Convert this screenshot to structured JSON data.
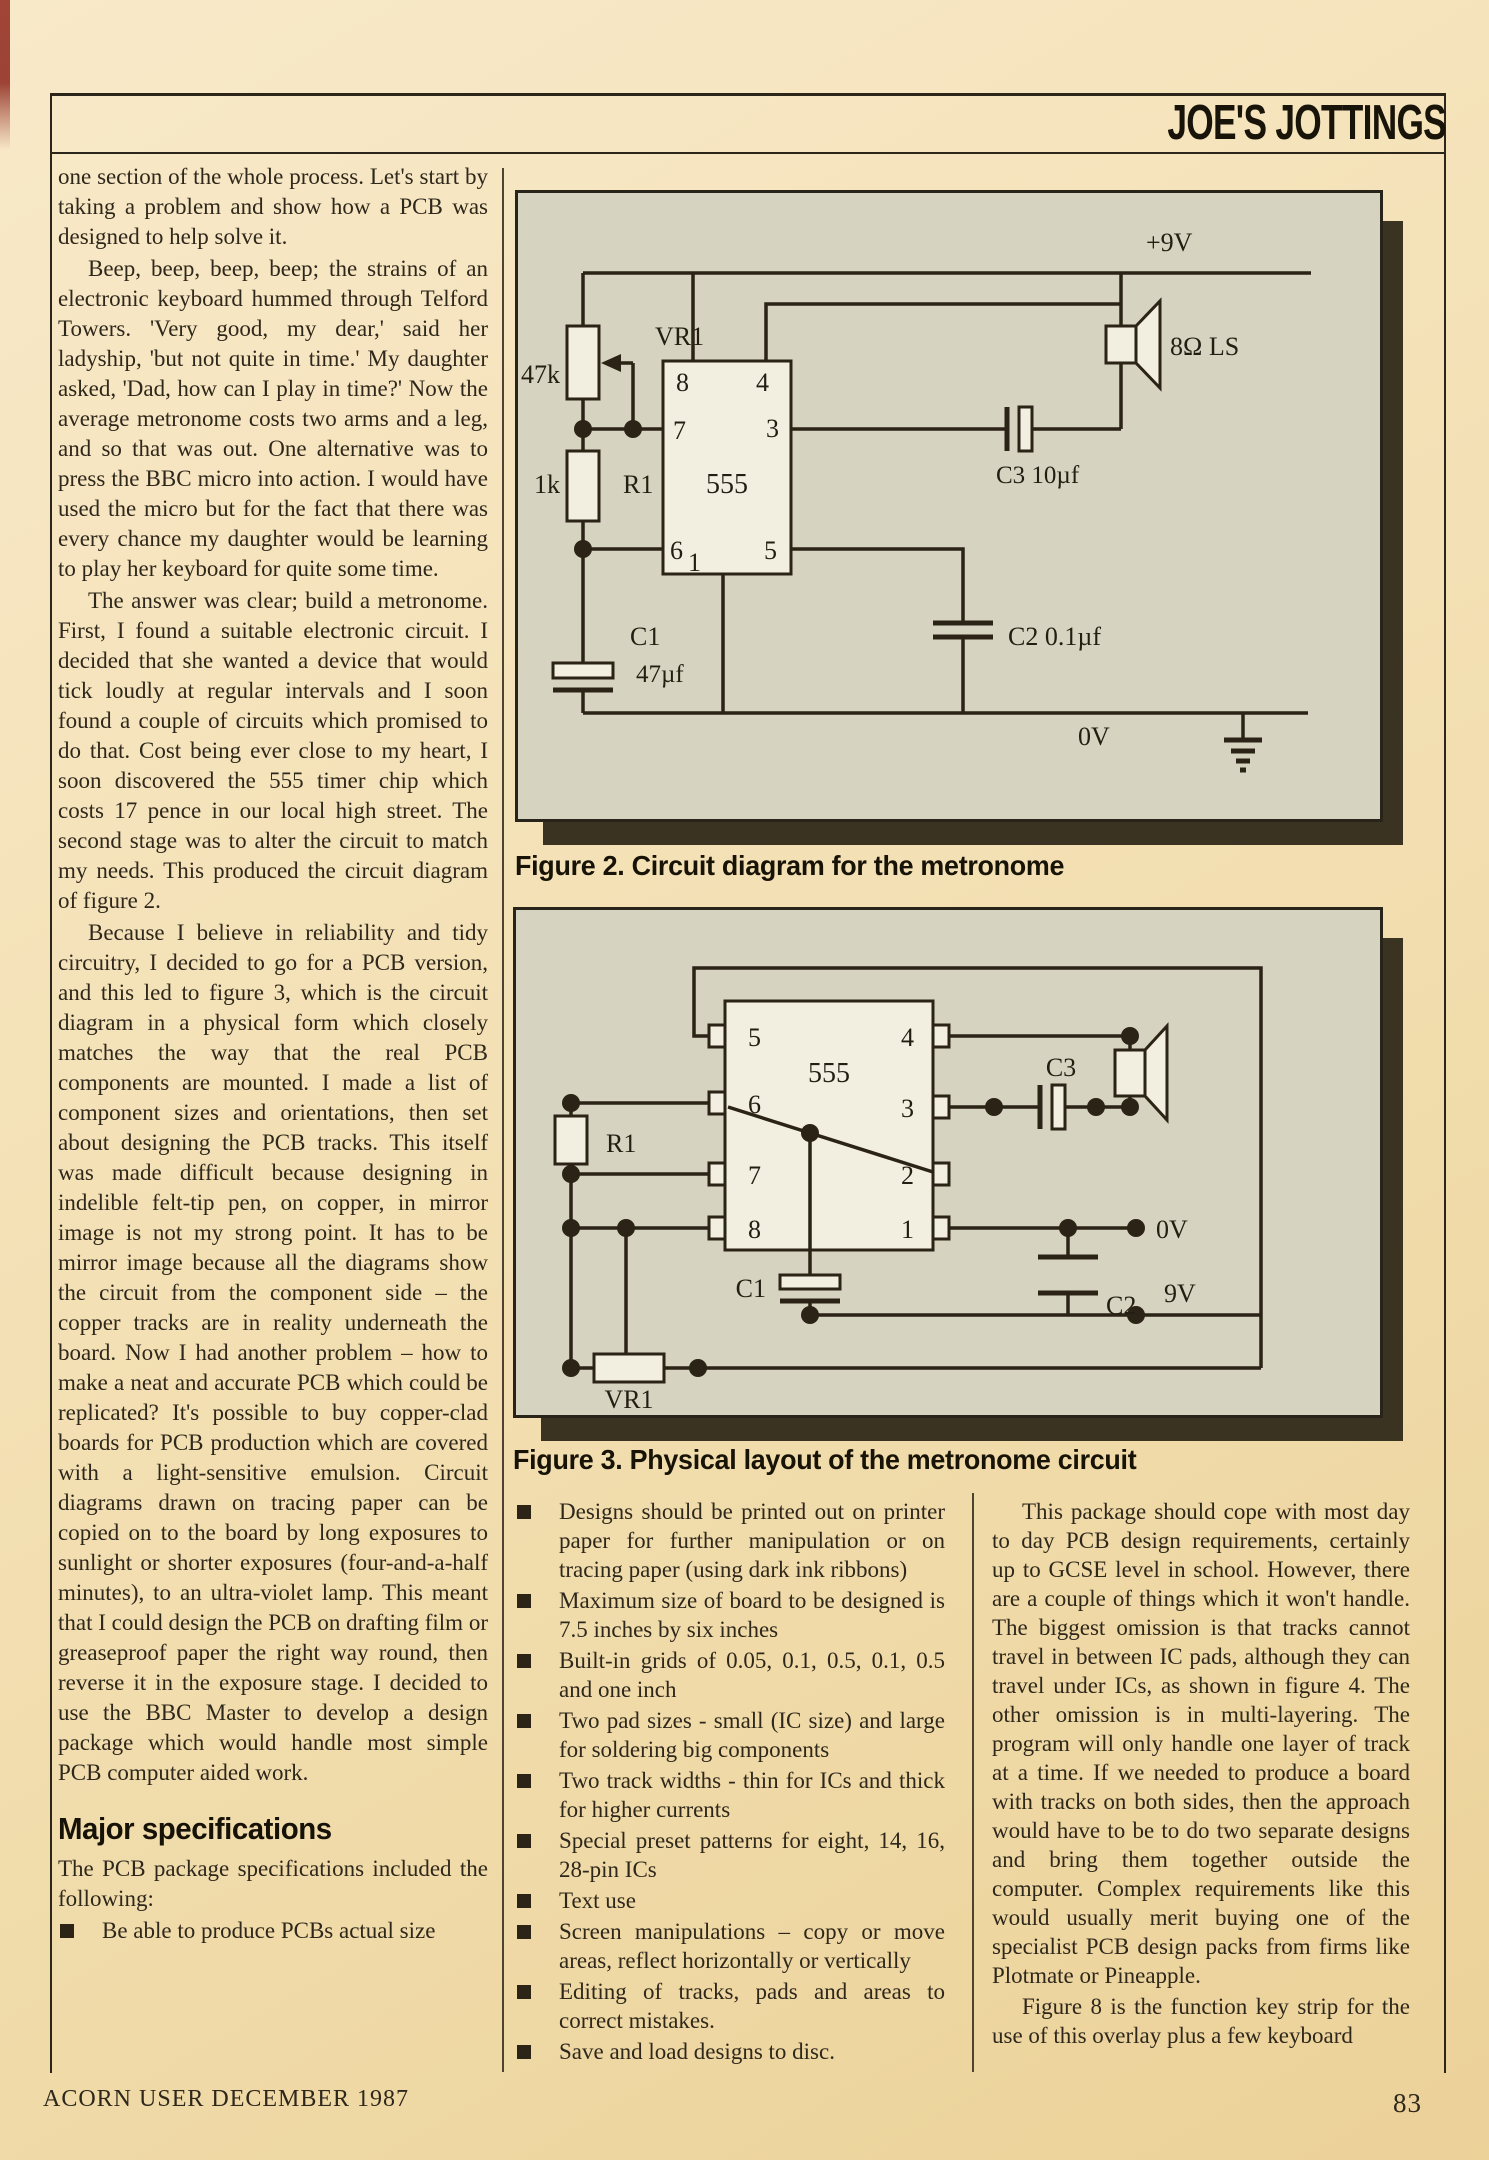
{
  "page": {
    "masthead": "JOE'S JOTTINGS",
    "footer_left": "ACORN USER DECEMBER 1987",
    "footer_right": "83"
  },
  "article": {
    "col1": {
      "p0": "one section of the whole process. Let's start by taking a problem and show how a PCB was designed to help solve it.",
      "p1": "Beep, beep, beep, beep; the strains of an electronic keyboard hummed through Telford Towers. 'Very good, my dear,' said her ladyship, 'but not quite in time.' My daughter asked, 'Dad, how can I play in time?' Now the average metronome costs two arms and a leg, and so that was out. One alternative was to press the BBC micro into action. I would have used the micro but for the fact that there was every chance my daughter would be learning to play her keyboard for quite some time.",
      "p2": "The answer was clear; build a metronome. First, I found a suitable electronic circuit. I decided that she wanted a device that would tick loudly at regular intervals and I soon found a couple of circuits which promised to do that. Cost being ever close to my heart, I soon discovered the 555 timer chip which costs 17 pence in our local high street. The second stage was to alter the circuit to match my needs. This produced the circuit diagram of figure 2.",
      "p3": "Because I believe in reliability and tidy circuitry, I decided to go for a PCB version, and this led to figure 3, which is the circuit diagram in a physical form which closely matches the way that the real PCB components are mounted. I made a list of component sizes and orientations, then set about designing the PCB tracks. This itself was made difficult because designing in indelible felt-tip pen, on copper, in mirror image is not my strong point. It has to be mirror image because all the diagrams show the circuit from the component side – the copper tracks are in reality underneath the board. Now I had another problem – how to make a neat and accurate PCB which could be replicated? It's possible to buy copper-clad boards for PCB production which are covered with a light-sensitive emulsion. Circuit diagrams drawn on tracing paper can be copied on to the board by long exposures to sunlight or shorter exposures (four-and-a-half minutes), to an ultra-violet lamp. This meant that I could design the PCB on drafting film or greaseproof paper the right way round, then reverse it in the exposure stage. I decided to use the BBC Master to develop a design package which would handle most simple PCB computer aided work.",
      "heading": "Major specifications",
      "intro": "The PCB package specifications included the following:",
      "bullet0": "Be able to produce PCBs actual size"
    },
    "middle_bullets": [
      "Designs should be printed out on printer paper for further manipulation or on tracing paper (using dark ink ribbons)",
      "Maximum size of board to be designed is 7.5 inches by six inches",
      "Built-in grids of 0.05, 0.1, 0.5, 0.1, 0.5 and one inch",
      "Two pad sizes - small (IC size) and large for soldering big components",
      "Two track widths - thin for ICs and thick for higher currents",
      "Special preset patterns for eight, 14, 16, 28-pin ICs",
      "Text use",
      "Screen manipulations – copy or move areas, reflect horizontally or vertically",
      "Editing of tracks, pads and areas to correct mistakes.",
      "Save and load designs to disc."
    ],
    "col3": {
      "p0": "This package should cope with most day to day PCB design requirements, certainly up to GCSE level in school. However, there are a couple of things which it won't handle. The biggest omission is that tracks cannot travel in between IC pads, although they can travel under ICs, as shown in figure 4. The other omission is in multi-layering. The program will only handle one layer of track at a time. If we needed to produce a board with tracks on both sides, then the approach would have to be to do two separate designs and bring them together outside the computer. Complex requirements like this would usually merit buying one of the specialist PCB design packs from firms like Plotmate or Pineapple.",
      "p1": "Figure 8 is the function key strip for the use of this overlay plus a few keyboard"
    }
  },
  "figure2": {
    "caption": "Figure 2. Circuit diagram for the metronome",
    "labels": {
      "rail_top": "+9V",
      "rail_bottom": "0V",
      "vr1": "VR1",
      "vr1_value": "47k",
      "r1": "R1",
      "r1_value": "1k",
      "c1": "C1",
      "c1_value": "47µf",
      "c2": "C2  0.1µf",
      "c3": "C3  10µf",
      "ic": "555",
      "speaker": "8Ω LS",
      "pin8": "8",
      "pin4": "4",
      "pin7": "7",
      "pin3": "3",
      "pin6": "6",
      "pin1": "1",
      "pin5": "5"
    }
  },
  "figure3": {
    "caption": "Figure 3. Physical layout of the metronome circuit",
    "labels": {
      "ic": "555",
      "r1": "R1",
      "vr1": "VR1",
      "c1": "C1",
      "c2": "C2",
      "c3": "C3",
      "ov": "0V",
      "v9": "9V",
      "pin5": "5",
      "pin6": "6",
      "pin7": "7",
      "pin8": "8",
      "pin4": "4",
      "pin3": "3",
      "pin2": "2",
      "pin1": "1"
    }
  }
}
